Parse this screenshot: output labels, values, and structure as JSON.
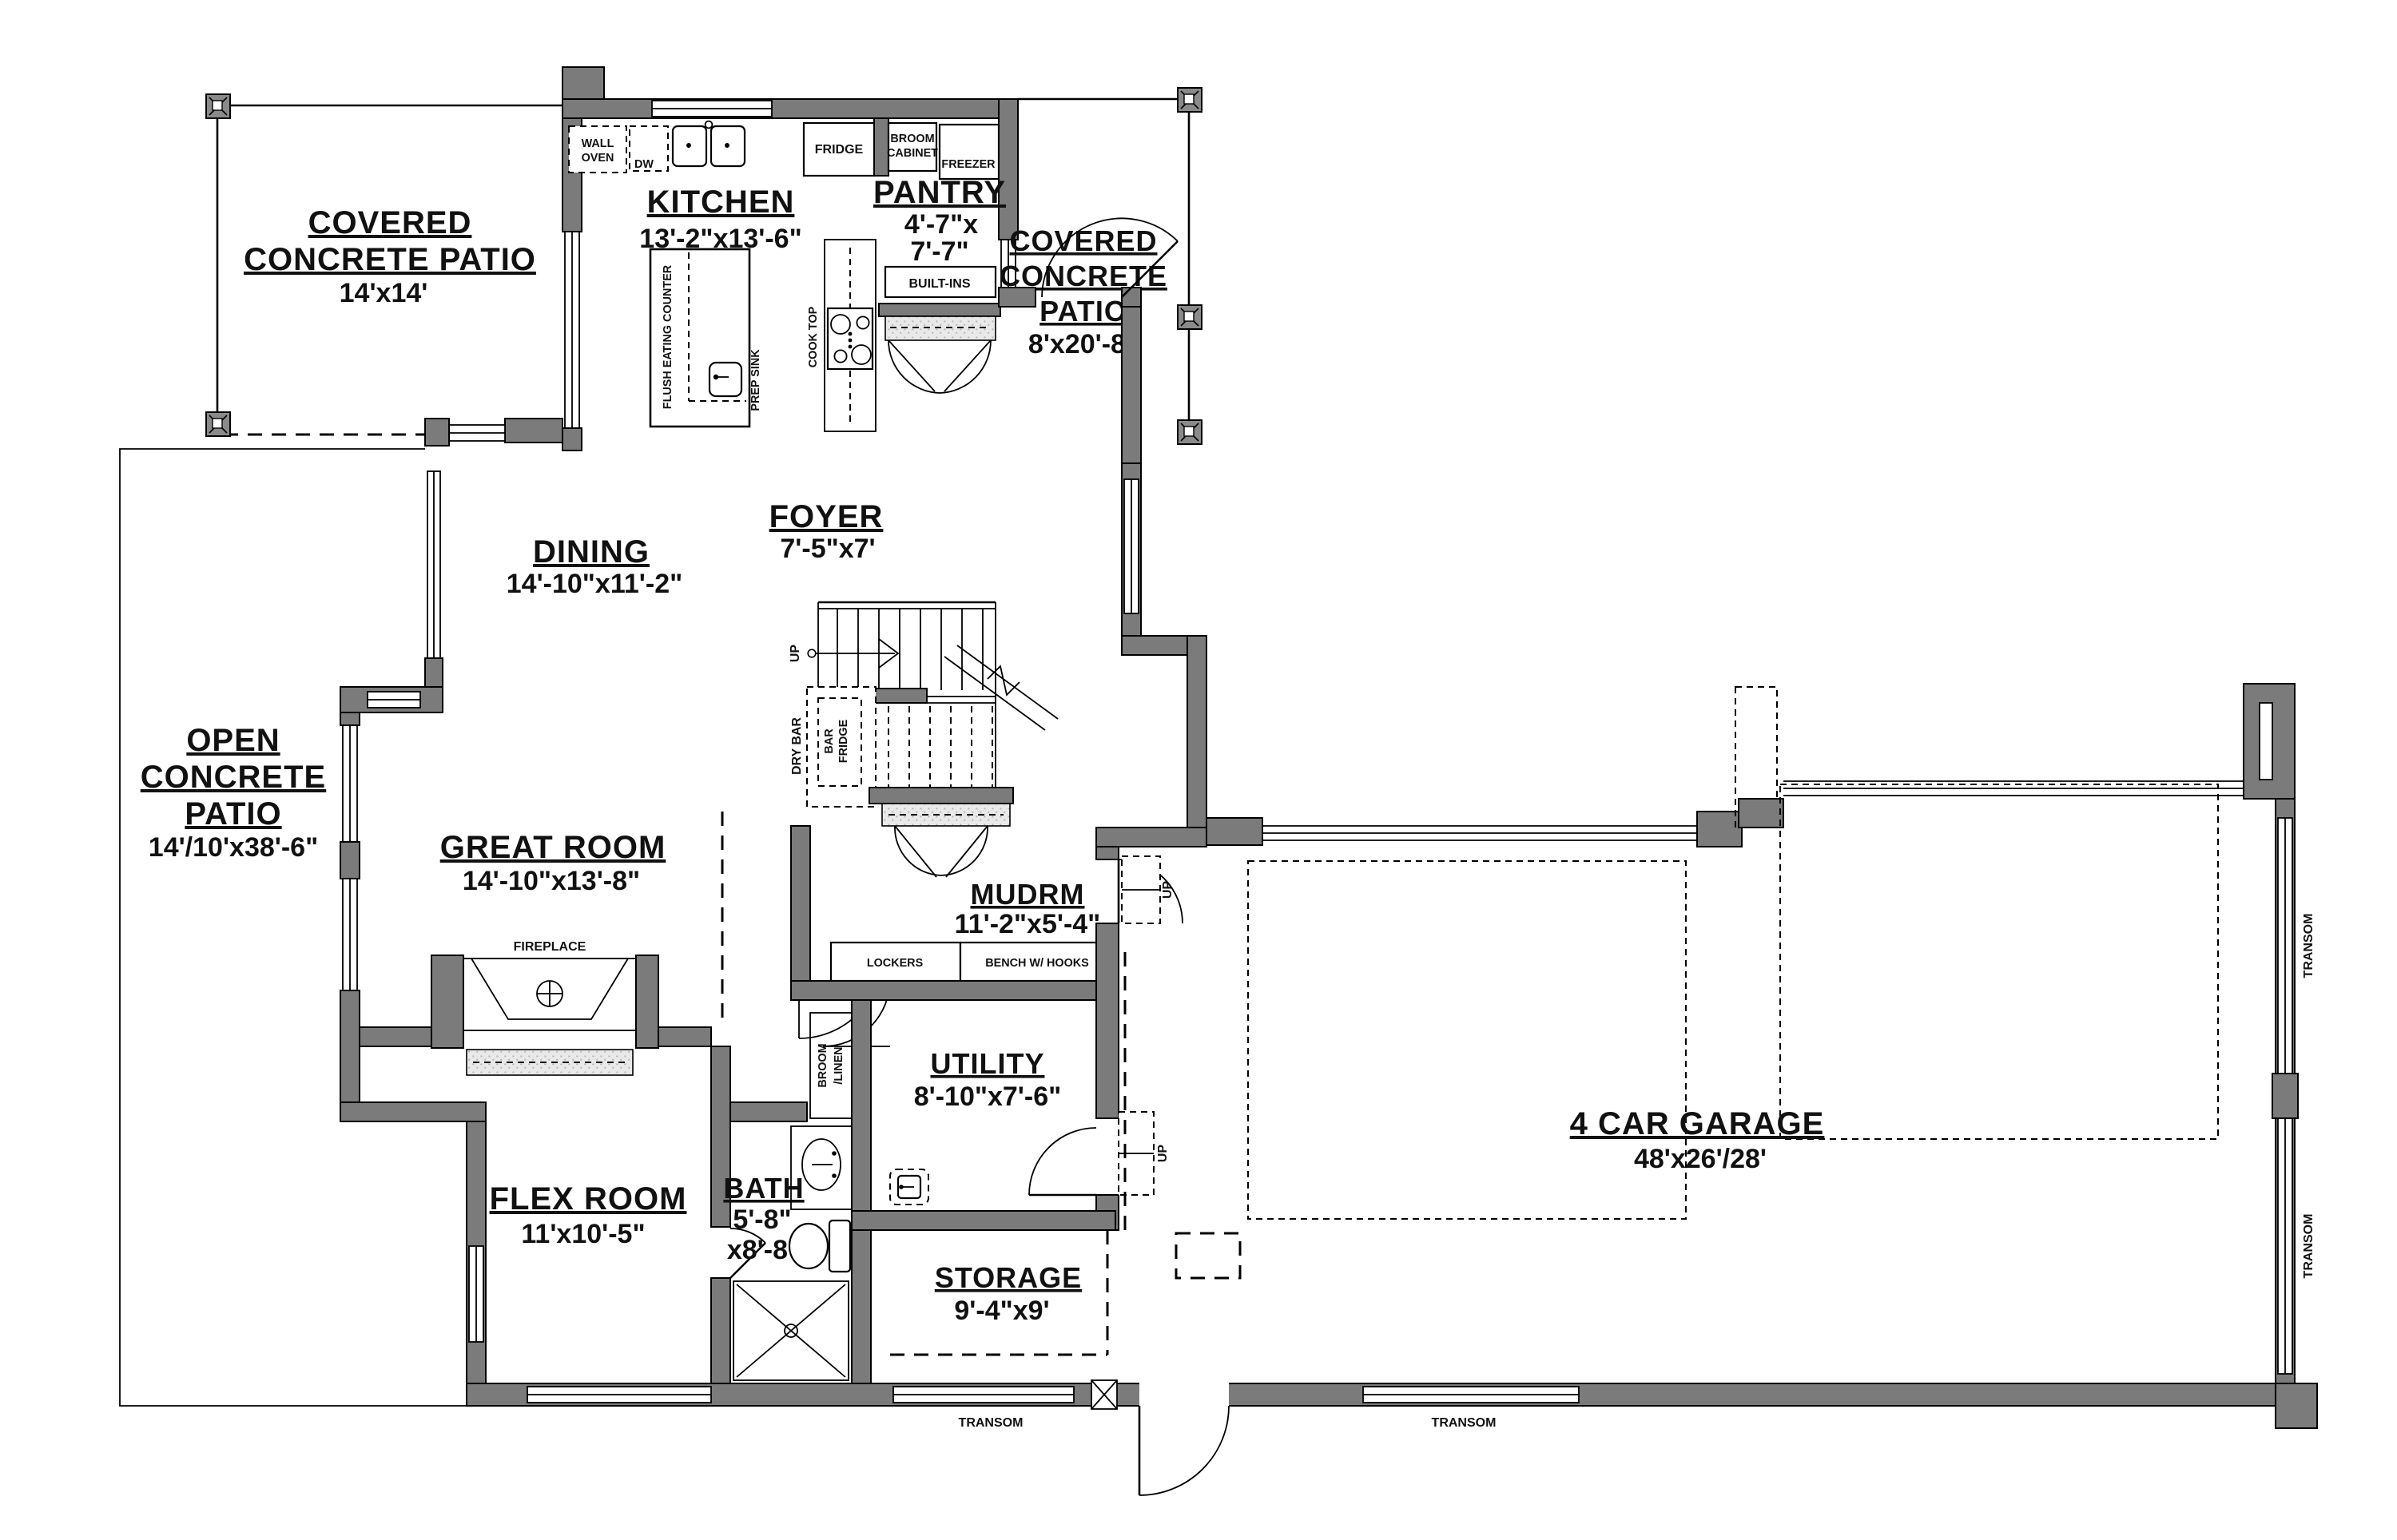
{
  "rooms": {
    "covered_patio_left": {
      "line1": "COVERED",
      "line2": "CONCRETE PATIO",
      "dims": "14'x14'"
    },
    "kitchen": {
      "name": "KITCHEN",
      "dims": "13'-2\"x13'-6\""
    },
    "pantry": {
      "name": "PANTRY",
      "dims_line1": "4'-7\"x",
      "dims_line2": "7'-7\""
    },
    "covered_patio_right": {
      "line1": "COVERED",
      "line2": "CONCRETE",
      "line3": "PATIO",
      "dims": "8'x20'-8\""
    },
    "foyer": {
      "name": "FOYER",
      "dims": "7'-5\"x7'"
    },
    "dining": {
      "name": "DINING",
      "dims": "14'-10\"x11'-2\""
    },
    "open_patio": {
      "line1": "OPEN",
      "line2": "CONCRETE",
      "line3": "PATIO",
      "dims": "14'/10'x38'-6\""
    },
    "great_room": {
      "name": "GREAT ROOM",
      "dims": "14'-10\"x13'-8\""
    },
    "mudroom": {
      "name": "MUDRM",
      "dims": "11'-2\"x5'-4\""
    },
    "utility": {
      "name": "UTILITY",
      "dims": "8'-10\"x7'-6\""
    },
    "flex_room": {
      "name": "FLEX ROOM",
      "dims": "11'x10'-5\""
    },
    "bath": {
      "name": "BATH",
      "dims_line1": "5'-8\"",
      "dims_line2": "x8'-8\""
    },
    "storage": {
      "name": "STORAGE",
      "dims": "9'-4\"x9'"
    },
    "garage": {
      "name": "4 CAR GARAGE",
      "dims": "48'x26'/28'"
    }
  },
  "fixtures": {
    "wall_oven_line1": "WALL",
    "wall_oven_line2": "OVEN",
    "dishwasher": "DW",
    "fridge": "FRIDGE",
    "broom_cabinet_line1": "BROOM",
    "broom_cabinet_line2": "CABINET",
    "freezer": "FREEZER",
    "built_ins": "BUILT-INS",
    "cook_top": "COOK TOP",
    "flush_eating_counter": "FLUSH EATING COUNTER",
    "prep_sink": "PREP SINK",
    "dry_bar": "DRY BAR",
    "bar_fridge_line1": "BAR",
    "bar_fridge_line2": "FRIDGE",
    "lockers": "LOCKERS",
    "bench": "BENCH W/ HOOKS",
    "broom_linen_line1": "BROOM",
    "broom_linen_line2": "/LINEN",
    "fireplace": "FIREPLACE"
  },
  "labels": {
    "up": "UP",
    "transom": "TRANSOM"
  },
  "colors": {
    "wall": "#7b7b7b",
    "line": "#000000",
    "hatch_fill": "#e3e3e3",
    "background": "#ffffff",
    "text": "#111111"
  }
}
